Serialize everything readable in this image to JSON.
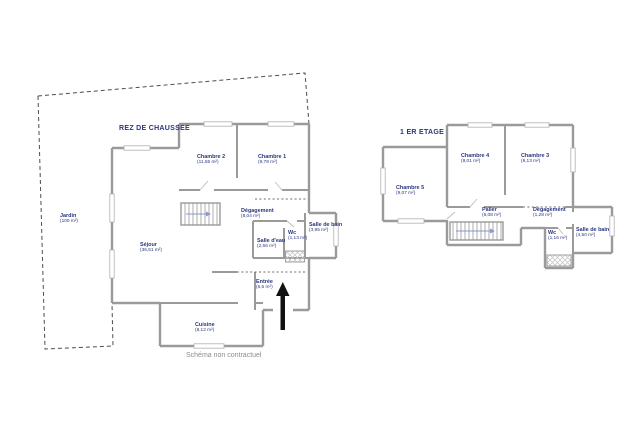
{
  "caption": "Schéma non contractuel",
  "colors": {
    "label_navy": "#2a357f",
    "wall_gray": "#9a9a9a",
    "caption_gray": "#8c8c8c",
    "arrow_black": "#111111"
  },
  "ground_floor": {
    "title": "REZ DE CHAUSSEE",
    "rooms": {
      "jardin": {
        "name": "Jardin",
        "area": "(100 m²)"
      },
      "chambre2": {
        "name": "Chambre 2",
        "area": "(11,55 m²)"
      },
      "chambre1": {
        "name": "Chambre 1",
        "area": "(9,78 m²)"
      },
      "degagement": {
        "name": "Dégagement",
        "area": "(8,04 m²)"
      },
      "salle_eau": {
        "name": "Salle d'eau",
        "area": "(2,56 m²)"
      },
      "wc": {
        "name": "Wc",
        "area": "(1,13 m²)"
      },
      "salle_bain": {
        "name": "Salle de bain",
        "area": "(3,95 m²)"
      },
      "sejour": {
        "name": "Séjour",
        "area": "(36,51 m²)"
      },
      "cuisine": {
        "name": "Cuisine",
        "area": "(8,12 m²)"
      },
      "entree": {
        "name": "Entrée",
        "area": "(6,5 m²)"
      }
    }
  },
  "first_floor": {
    "title": "1 ER ETAGE",
    "rooms": {
      "chambre5": {
        "name": "Chambre 5",
        "area": "(9,07 m²)"
      },
      "chambre4": {
        "name": "Chambre 4",
        "area": "(9,01 m²)"
      },
      "chambre3": {
        "name": "Chambre 3",
        "area": "(9,13 m²)"
      },
      "palier": {
        "name": "Palier",
        "area": "(6,08 m²)"
      },
      "degagement": {
        "name": "Dégagement",
        "area": "(1,28 m²)"
      },
      "wc": {
        "name": "Wc",
        "area": "(1,16 m²)"
      },
      "salle_bain": {
        "name": "Salle de bain",
        "area": "(4,50 m²)"
      }
    }
  }
}
